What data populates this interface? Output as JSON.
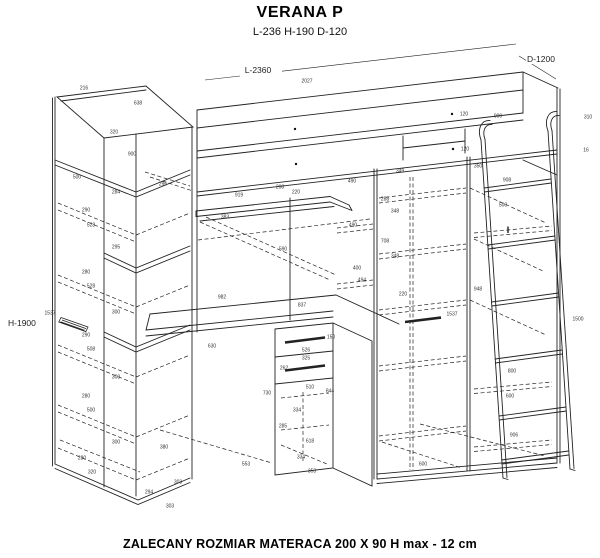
{
  "header": {
    "title": "VERANA P",
    "subtitle": "L-236 H-190 D-120"
  },
  "footer": {
    "note": "ZALECANY ROZMIAR MATERACA 200 X 90  H max - 12 cm"
  },
  "drawing": {
    "main_dimensions": {
      "length": "L-2360",
      "depth": "D-1200",
      "height": "H-1900"
    },
    "line_color": "#222222",
    "annotations": [
      {
        "t": "216",
        "x": 84,
        "y": 89
      },
      {
        "t": "638",
        "x": 138,
        "y": 104
      },
      {
        "t": "320",
        "x": 114,
        "y": 133
      },
      {
        "t": "900",
        "x": 132,
        "y": 155
      },
      {
        "t": "500",
        "x": 77,
        "y": 178
      },
      {
        "t": "284",
        "x": 116,
        "y": 193
      },
      {
        "t": "296",
        "x": 163,
        "y": 185
      },
      {
        "t": "290",
        "x": 86,
        "y": 211
      },
      {
        "t": "528",
        "x": 91,
        "y": 226
      },
      {
        "t": "295",
        "x": 116,
        "y": 248
      },
      {
        "t": "280",
        "x": 86,
        "y": 273
      },
      {
        "t": "528",
        "x": 91,
        "y": 287
      },
      {
        "t": "300",
        "x": 116,
        "y": 313
      },
      {
        "t": "1537",
        "x": 50,
        "y": 314
      },
      {
        "t": "290",
        "x": 86,
        "y": 336
      },
      {
        "t": "508",
        "x": 91,
        "y": 350
      },
      {
        "t": "300",
        "x": 116,
        "y": 378
      },
      {
        "t": "280",
        "x": 86,
        "y": 397
      },
      {
        "t": "500",
        "x": 91,
        "y": 411
      },
      {
        "t": "300",
        "x": 116,
        "y": 443
      },
      {
        "t": "280",
        "x": 82,
        "y": 459
      },
      {
        "t": "320",
        "x": 92,
        "y": 473
      },
      {
        "t": "294",
        "x": 149,
        "y": 493
      },
      {
        "t": "303",
        "x": 178,
        "y": 483
      },
      {
        "t": "303",
        "x": 170,
        "y": 507
      },
      {
        "t": "380",
        "x": 164,
        "y": 448
      },
      {
        "t": "2027",
        "x": 307,
        "y": 82
      },
      {
        "t": "120",
        "x": 464,
        "y": 115
      },
      {
        "t": "120",
        "x": 465,
        "y": 150
      },
      {
        "t": "900",
        "x": 498,
        "y": 117
      },
      {
        "t": "310",
        "x": 588,
        "y": 118
      },
      {
        "t": "16",
        "x": 586,
        "y": 151
      },
      {
        "t": "919",
        "x": 239,
        "y": 196
      },
      {
        "t": "220",
        "x": 296,
        "y": 193
      },
      {
        "t": "208",
        "x": 280,
        "y": 188
      },
      {
        "t": "383",
        "x": 225,
        "y": 218
      },
      {
        "t": "590",
        "x": 283,
        "y": 250
      },
      {
        "t": "982",
        "x": 222,
        "y": 298
      },
      {
        "t": "837",
        "x": 302,
        "y": 306
      },
      {
        "t": "630",
        "x": 212,
        "y": 347
      },
      {
        "t": "150",
        "x": 331,
        "y": 338
      },
      {
        "t": "526",
        "x": 306,
        "y": 351
      },
      {
        "t": "325",
        "x": 306,
        "y": 359
      },
      {
        "t": "262",
        "x": 284,
        "y": 369
      },
      {
        "t": "730",
        "x": 267,
        "y": 394
      },
      {
        "t": "510",
        "x": 310,
        "y": 388
      },
      {
        "t": "844",
        "x": 330,
        "y": 392
      },
      {
        "t": "334",
        "x": 297,
        "y": 411
      },
      {
        "t": "285",
        "x": 283,
        "y": 427
      },
      {
        "t": "618",
        "x": 310,
        "y": 442
      },
      {
        "t": "334",
        "x": 301,
        "y": 458
      },
      {
        "t": "553",
        "x": 246,
        "y": 465
      },
      {
        "t": "353",
        "x": 312,
        "y": 472
      },
      {
        "t": "490",
        "x": 352,
        "y": 182
      },
      {
        "t": "349",
        "x": 400,
        "y": 172
      },
      {
        "t": "288",
        "x": 385,
        "y": 200
      },
      {
        "t": "348",
        "x": 395,
        "y": 212
      },
      {
        "t": "490",
        "x": 353,
        "y": 226
      },
      {
        "t": "708",
        "x": 385,
        "y": 242
      },
      {
        "t": "348",
        "x": 395,
        "y": 257
      },
      {
        "t": "400",
        "x": 357,
        "y": 269
      },
      {
        "t": "494",
        "x": 362,
        "y": 281
      },
      {
        "t": "220",
        "x": 403,
        "y": 295
      },
      {
        "t": "1537",
        "x": 452,
        "y": 315
      },
      {
        "t": "350",
        "x": 478,
        "y": 167
      },
      {
        "t": "908",
        "x": 507,
        "y": 181
      },
      {
        "t": "500",
        "x": 503,
        "y": 206
      },
      {
        "t": "948",
        "x": 478,
        "y": 290
      },
      {
        "t": "800",
        "x": 512,
        "y": 372
      },
      {
        "t": "600",
        "x": 510,
        "y": 397
      },
      {
        "t": "906",
        "x": 514,
        "y": 436
      },
      {
        "t": "600",
        "x": 423,
        "y": 465
      },
      {
        "t": "1500",
        "x": 578,
        "y": 320
      }
    ]
  }
}
